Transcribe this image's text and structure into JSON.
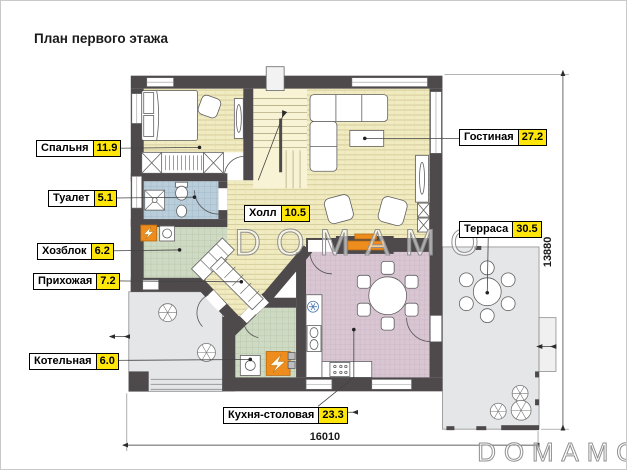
{
  "title": "План первого этажа",
  "watermark": {
    "center": "DOMAMO",
    "corner": "DOMAMO"
  },
  "dimensions": {
    "width_mm": "16010",
    "height_mm": "13880"
  },
  "rooms": [
    {
      "name": "Спальня",
      "area": "11.9"
    },
    {
      "name": "Туалет",
      "area": "5.1"
    },
    {
      "name": "Хозблок",
      "area": "6.2"
    },
    {
      "name": "Прихожая",
      "area": "7.2"
    },
    {
      "name": "Котельная",
      "area": "6.0"
    },
    {
      "name": "Холл",
      "area": "10.5"
    },
    {
      "name": "Гостиная",
      "area": "27.2"
    },
    {
      "name": "Терраса",
      "area": "30.5"
    },
    {
      "name": "Кухня-столовая",
      "area": "23.3"
    }
  ],
  "colors": {
    "wall": "#4e4a4c",
    "area_badge": "#ffe60a",
    "wood_floor": "#f1ebc1",
    "stairs_floor": "#f7f3d4",
    "tile_blue": "#b9cdda",
    "tile_green": "#cfdac4",
    "tile_pink": "#d9c6d3",
    "outdoor_gray": "#e5e6e8",
    "accent_orange": "#ee8c1e"
  }
}
